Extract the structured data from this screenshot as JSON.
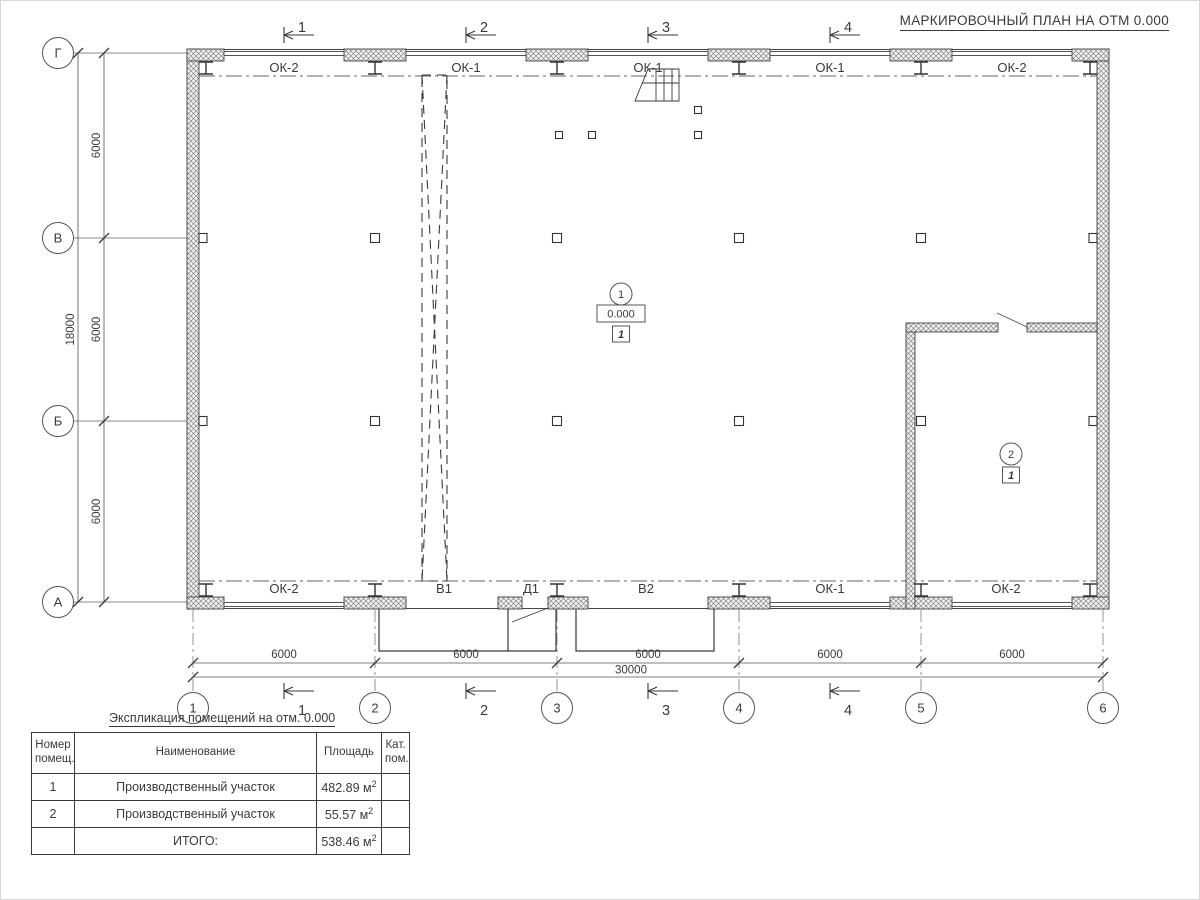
{
  "plan": {
    "title": "МАРКИРОВОЧНЫЙ ПЛАН НА ОТМ 0.000"
  },
  "axes": {
    "cols": [
      "1",
      "2",
      "3",
      "4",
      "5",
      "6"
    ],
    "rows": [
      "Г",
      "В",
      "Б",
      "А"
    ]
  },
  "sections": {
    "top": [
      "1",
      "2",
      "3",
      "4"
    ],
    "bottom": [
      "1",
      "2",
      "3",
      "4"
    ]
  },
  "dims": {
    "col_segments": [
      "6000",
      "6000",
      "6000",
      "6000",
      "6000"
    ],
    "col_total": "30000",
    "row_segments": [
      "6000",
      "6000",
      "6000"
    ],
    "row_total": "18000"
  },
  "openings": {
    "top": [
      "ОК-2",
      "ОК-1",
      "ОК-1",
      "ОК-1",
      "ОК-2"
    ],
    "bottom": [
      "ОК-2",
      "В1",
      "Д1",
      "В2",
      "ОК-1",
      "ОК-2"
    ]
  },
  "rooms": {
    "r1": {
      "number": "1",
      "elevation": "0.000",
      "category": "1"
    },
    "r2": {
      "number": "2",
      "category": "1"
    }
  },
  "schedule": {
    "title": "Экспликация помещений на отм. 0.000",
    "headers": {
      "num": "Номер\nпомещ.",
      "name": "Наименование",
      "area": "Площадь",
      "cat": "Кат.\nпом."
    },
    "rows": [
      {
        "num": "1",
        "name": "Производственный участок",
        "area": "482.89 м",
        "sup": "2",
        "cat": ""
      },
      {
        "num": "2",
        "name": "Производственный участок",
        "area": "55.57 м",
        "sup": "2",
        "cat": ""
      }
    ],
    "total": {
      "label": "ИТОГО:",
      "area": "538.46 м",
      "sup": "2"
    }
  }
}
